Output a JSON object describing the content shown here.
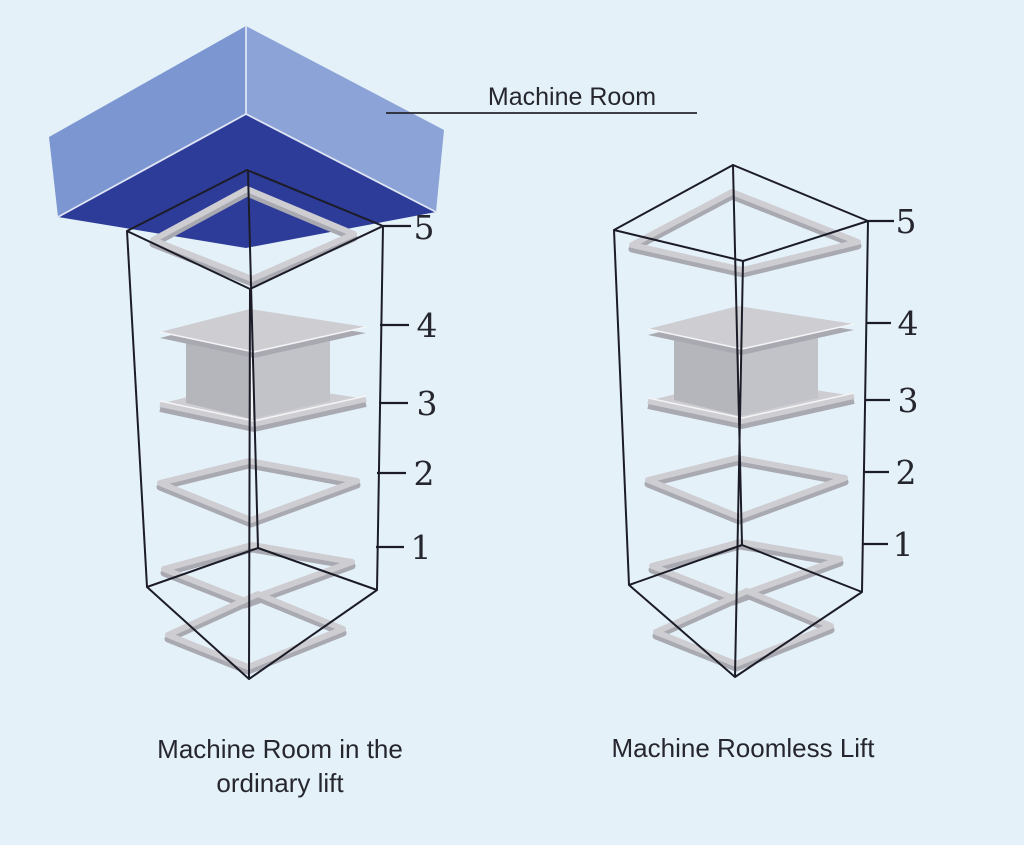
{
  "diagram": {
    "machine_room_label": "Machine Room",
    "left_caption_line1": "Machine Room in the",
    "left_caption_line2": "ordinary lift",
    "right_caption": "Machine Roomless Lift",
    "floor_labels": [
      "5",
      "4",
      "3",
      "2",
      "1"
    ]
  },
  "colors": {
    "background": "#E4F1F8",
    "box_top_left": "#7B96D0",
    "box_top_right": "#8CA3D8",
    "box_underside": "#2E3C99",
    "wireframe": "#1C1C28",
    "slab_light": "#CDCDD2",
    "slab_shadow": "#A9A9B1",
    "car_left_face": "#B5B6BC",
    "car_right_face": "#C2C3C8",
    "text": "#26262E"
  }
}
